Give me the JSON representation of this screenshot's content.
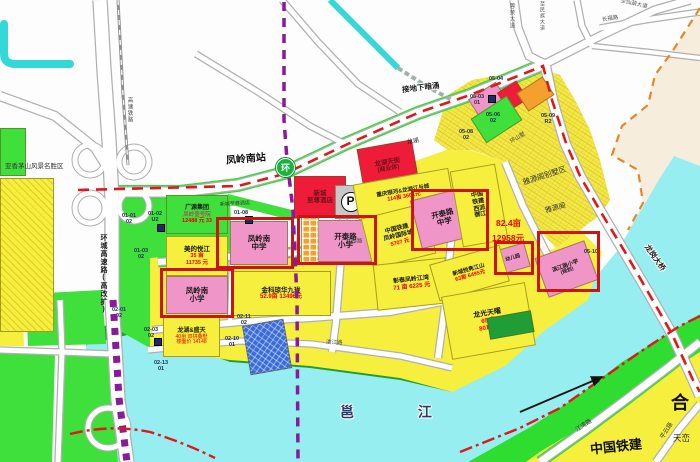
{
  "palette": {
    "yellow": "#f6ef3e",
    "green": "#3fe03c",
    "dark_green": "#1f9e38",
    "bright_green": "#2fdd30",
    "pink": "#f095c8",
    "red": "#ee1c38",
    "dark_red_text": "#70101c",
    "orange": "#f59f2f",
    "gray": "#c8c8c8",
    "blue": "#3a6cd8",
    "navy_icon": "#1a2a6a",
    "water": "#97eef0",
    "stream": "#35d8d8",
    "cream": "#f6eddc",
    "boundary_orange": "#e0882a",
    "red_line": "#e01818",
    "metro_purple": "#8a1a9a",
    "highlight_box": "#cc1414",
    "price_red": "#e60000",
    "text_dark": "#1a1a1a"
  },
  "station": {
    "t": "环",
    "name": "凤岭南站"
  },
  "labels": [
    {
      "id": "scenic-area-label",
      "t": "亚香茅山风景名胜区",
      "x": 5,
      "y": 164,
      "s": 6.5,
      "c": "#333333"
    },
    {
      "id": "ring-expressway-label",
      "t": "环城高速路(高改扩)",
      "x": 100,
      "y": 234,
      "s": 7,
      "b": 1,
      "v": 1,
      "c": "#1a1a1a"
    },
    {
      "id": "hsr-label",
      "t": "高速铁路",
      "x": 126,
      "y": 97,
      "s": 5.5,
      "v": 1,
      "c": "#444444"
    },
    {
      "id": "culvert-label",
      "t": "接地下暗涌",
      "x": 402,
      "y": 84,
      "s": 7.5,
      "b": 1,
      "r": -7,
      "c": "#1a1a1a",
      "halo": 1
    },
    {
      "id": "station-label",
      "t": "凤岭南站",
      "x": 226,
      "y": 155,
      "s": 10,
      "b": 1,
      "r": -5,
      "c": "#101010",
      "halo": 1
    },
    {
      "id": "rongmo-ave-label",
      "t": "蓉茉大道",
      "x": 508,
      "y": 3,
      "s": 5.5,
      "v": 1,
      "c": "#555555"
    },
    {
      "id": "minzu-ave-label",
      "t": "至民族大道",
      "x": 539,
      "y": 1,
      "s": 5,
      "v": 1,
      "c": "#555555"
    },
    {
      "id": "changfu-rd-label",
      "t": "长福路",
      "x": 602,
      "y": 17,
      "s": 5.5,
      "r": -9,
      "c": "#555555"
    },
    {
      "id": "xianhu-ave-label",
      "t": "至仙葫大道",
      "x": 620,
      "y": 2,
      "s": 5.5,
      "r": 13,
      "c": "#555555"
    },
    {
      "id": "longgang-bridge-label",
      "t": "龙岗大桥",
      "x": 640,
      "y": 254,
      "s": 7.5,
      "b": 1,
      "r": 55,
      "c": "#222222",
      "halo": 1
    },
    {
      "id": "jiangwan-rd-label",
      "t": "江湾路",
      "x": 575,
      "y": 423,
      "s": 6,
      "r": -33,
      "c": "#333333"
    },
    {
      "id": "pingyun-rd-label",
      "t": "平云路",
      "x": 658,
      "y": 428,
      "s": 6,
      "r": -58,
      "c": "#333333"
    },
    {
      "id": "binjiang-rd-label",
      "t": "滨江路",
      "x": 326,
      "y": 341,
      "s": 5.5,
      "r": 2,
      "c": "#444444"
    },
    {
      "id": "kaitai-rd-label",
      "t": "开泰路",
      "x": 346,
      "y": 240,
      "s": 5.5,
      "r": -4,
      "c": "#444444"
    },
    {
      "id": "yongjiang-river-label",
      "t": "邕 江",
      "x": 340,
      "y": 405,
      "s": 14,
      "b": 1,
      "sp": 30,
      "c": "#2b3a66",
      "halo": 1
    },
    {
      "id": "he-label",
      "t": "合",
      "x": 671,
      "y": 394,
      "s": 18,
      "b": 1,
      "c": "#111111"
    },
    {
      "id": "tianluan-label",
      "t": "天峦",
      "x": 673,
      "y": 434,
      "s": 8.5,
      "c": "#222222"
    },
    {
      "id": "tiejian-bottom-label",
      "t": "中国铁建",
      "x": 590,
      "y": 440,
      "s": 13,
      "b": 1,
      "r": -6,
      "c": "#111111"
    },
    {
      "id": "area-82-label",
      "t": "82.4亩",
      "x": 496,
      "y": 219,
      "s": 8.5,
      "b": 1,
      "c": "#e60000"
    },
    {
      "id": "price-12958-label",
      "t": "12958元",
      "x": 492,
      "y": 234,
      "s": 8.5,
      "b": 1,
      "c": "#e60000"
    },
    {
      "id": "yayuange-villa-label",
      "t": "雅源阁别墅区",
      "x": 522,
      "y": 172,
      "s": 7.5,
      "r": -18,
      "c": "#333333"
    },
    {
      "id": "yayuange-label",
      "t": "雅源阁",
      "x": 545,
      "y": 205,
      "s": 7,
      "r": -15,
      "c": "#333333"
    },
    {
      "id": "longhu-small-label",
      "t": "龙湖",
      "x": 407,
      "y": 139,
      "s": 6,
      "r": -10,
      "c": "#222222"
    },
    {
      "id": "hotel-small-label",
      "t": "新城至尊酒店",
      "x": 220,
      "y": 202,
      "s": 5,
      "r": -3,
      "c": "#333333"
    },
    {
      "id": "huanshanshu-label",
      "t": "环山墅",
      "x": 510,
      "y": 136,
      "s": 5.5,
      "r": -30,
      "c": "#444444"
    }
  ],
  "parcels": [
    {
      "id": "parcel-left-yellow",
      "x": 0,
      "y": 178,
      "w": 54,
      "h": 154,
      "fill": "yellow",
      "hatch": "diag"
    },
    {
      "id": "parcel-left-green",
      "x": 0,
      "y": 128,
      "w": 26,
      "h": 48,
      "fill": "green"
    },
    {
      "id": "parcel-guangyuan",
      "x": 166,
      "y": 195,
      "w": 62,
      "h": 39,
      "fill": "green",
      "lines": [
        {
          "t": "广源集团",
          "s": 6,
          "b": 1
        },
        {
          "t": "凤岭壹号院",
          "s": 5.5,
          "c": "#c02050"
        },
        {
          "t": "12488 元 33",
          "s": 5.5,
          "b": 1,
          "c": "#e60000"
        }
      ]
    },
    {
      "id": "parcel-meide-yuejiang",
      "x": 166,
      "y": 236,
      "w": 62,
      "h": 40,
      "fill": "yellow",
      "lines": [
        {
          "t": "美的悦江",
          "s": 6.5,
          "b": 1
        },
        {
          "t": "35 亩",
          "s": 5.5,
          "b": 1,
          "c": "#e60000"
        },
        {
          "t": "11735 元",
          "s": 5.5,
          "b": 1,
          "c": "#e60000"
        }
      ]
    },
    {
      "id": "parcel-fenglingnan-primary",
      "x": 166,
      "y": 276,
      "w": 62,
      "h": 38,
      "fill": "pink",
      "lines": [
        {
          "t": "凤岭南",
          "s": 7.5,
          "b": 1
        },
        {
          "t": "小学",
          "s": 7.5,
          "b": 1
        }
      ]
    },
    {
      "id": "parcel-fenglingnan-middle",
      "x": 230,
      "y": 221,
      "w": 58,
      "h": 44,
      "fill": "pink",
      "lines": [
        {
          "t": "凤岭南",
          "s": 7.5,
          "b": 1
        },
        {
          "t": "中学",
          "s": 7.5,
          "b": 1
        }
      ]
    },
    {
      "id": "parcel-jinke",
      "x": 231,
      "y": 271,
      "w": 100,
      "h": 45,
      "fill": "yellow",
      "lines": [
        {
          "t": "金科琼华九珑",
          "s": 6.5,
          "b": 1
        },
        {
          "t": "52.9亩 13496元",
          "s": 6,
          "b": 1,
          "c": "#e60000"
        }
      ]
    },
    {
      "id": "parcel-longhu-shengtian",
      "x": 163,
      "y": 317,
      "w": 57,
      "h": 40,
      "fill": "yellow",
      "lines": [
        {
          "t": "龙湖&盛天",
          "s": 6,
          "b": 1
        },
        {
          "t": "40亩 双拼叠墅",
          "s": 5,
          "c": "#e60000"
        },
        {
          "t": "楼面价 14148",
          "s": 5,
          "c": "#e60000"
        }
      ]
    },
    {
      "id": "parcel-blue-site",
      "x": 246,
      "y": 322,
      "w": 42,
      "h": 50,
      "rot": -10,
      "fill": "blue",
      "hatch": "grid"
    },
    {
      "id": "parcel-hotel",
      "x": 294,
      "y": 176,
      "w": 52,
      "h": 42,
      "fill": "red",
      "lines": [
        {
          "t": "新城",
          "s": 6.5,
          "b": 1,
          "c": "#70101c"
        },
        {
          "t": "至尊酒店",
          "s": 6.5,
          "b": 1,
          "c": "#70101c"
        }
      ]
    },
    {
      "id": "parcel-parking",
      "x": 335,
      "y": 185,
      "w": 31,
      "h": 34,
      "fill": "gray",
      "badge": "P"
    },
    {
      "id": "parcel-kaitai-primary",
      "x": 318,
      "y": 220,
      "w": 55,
      "h": 42,
      "fill": "pink",
      "lines": [
        {
          "t": "开泰路",
          "s": 7.5,
          "b": 1
        },
        {
          "t": "小学",
          "s": 7.5,
          "b": 1
        }
      ]
    },
    {
      "id": "parcel-orange-strip",
      "x": 301,
      "y": 217,
      "w": 18,
      "h": 47,
      "fill": "orange",
      "hatch": "cells"
    },
    {
      "id": "parcel-longhu-tianjie",
      "x": 360,
      "y": 144,
      "w": 56,
      "h": 44,
      "rot": -10,
      "fill": "red",
      "lines": [
        {
          "t": "龙湖天街",
          "s": 6.5,
          "b": 1,
          "c": "#70101c"
        },
        {
          "t": "(商业体)",
          "s": 6,
          "b": 1,
          "c": "#70101c"
        }
      ]
    },
    {
      "id": "parcel-chongqing-yinhe",
      "x": 355,
      "y": 176,
      "w": 97,
      "h": 36,
      "rot": -10,
      "fill": "yellow",
      "lines": [
        {
          "t": "重庆银河&龙湖江与城",
          "s": 5.5,
          "b": 1
        },
        {
          "t": "114亩 3601元",
          "s": 5.5,
          "b": 1,
          "c": "#e60000"
        }
      ]
    },
    {
      "id": "parcel-tiejian-guojicheng",
      "x": 366,
      "y": 210,
      "w": 65,
      "h": 52,
      "rot": -14,
      "fill": "yellow",
      "lines": [
        {
          "t": "中国铁建",
          "s": 6,
          "b": 1
        },
        {
          "t": "凤岭国际城",
          "s": 6,
          "b": 1
        },
        {
          "t": "5707 元",
          "s": 5.5,
          "b": 1,
          "c": "#e60000"
        }
      ]
    },
    {
      "id": "parcel-kaitai-middle",
      "x": 415,
      "y": 193,
      "w": 57,
      "h": 50,
      "rot": -14,
      "fill": "pink",
      "lines": [
        {
          "t": "开泰路",
          "s": 7.5,
          "b": 1
        },
        {
          "t": "中学",
          "s": 7.5,
          "b": 1
        }
      ]
    },
    {
      "id": "parcel-xipai-yujiang",
      "x": 456,
      "y": 167,
      "w": 46,
      "h": 77,
      "rot": -10,
      "fill": "yellow",
      "lines": [
        {
          "t": "中国",
          "s": 6,
          "b": 1
        },
        {
          "t": "铁建",
          "s": 6,
          "b": 1
        },
        {
          "t": "西派",
          "s": 6,
          "b": 1
        },
        {
          "t": "御江",
          "s": 6,
          "b": 1
        }
      ]
    },
    {
      "id": "parcel-kindergarten",
      "x": 498,
      "y": 246,
      "w": 30,
      "h": 25,
      "rot": -16,
      "fill": "pink",
      "lines": [
        {
          "t": "幼儿园",
          "s": 5,
          "b": 1
        }
      ]
    },
    {
      "id": "parcel-binjiang-primary",
      "x": 540,
      "y": 248,
      "w": 53,
      "h": 42,
      "rot": -20,
      "fill": "pink",
      "lines": [
        {
          "t": "滨江路小学",
          "s": 5.5,
          "b": 1
        },
        {
          "t": "(规划)",
          "s": 5,
          "b": 1
        }
      ]
    },
    {
      "id": "parcel-zhangtai-jiangwan",
      "x": 375,
      "y": 261,
      "w": 73,
      "h": 46,
      "rot": -6,
      "fill": "yellow",
      "lines": [
        {
          "t": "彰泰凤岭江湾",
          "s": 6,
          "b": 1
        },
        {
          "t": "71 亩 6225 元",
          "s": 6,
          "b": 1,
          "c": "#e60000"
        }
      ]
    },
    {
      "id": "parcel-xincheng-yujun",
      "x": 433,
      "y": 254,
      "w": 73,
      "h": 38,
      "rot": -16,
      "fill": "yellow",
      "lines": [
        {
          "t": "新城悦隽江山",
          "s": 5.5,
          "b": 1
        },
        {
          "t": "63亩 6495元",
          "s": 5.5,
          "b": 1,
          "c": "#e60000"
        }
      ]
    },
    {
      "id": "parcel-longguang-tianyao",
      "x": 446,
      "y": 289,
      "w": 85,
      "h": 64,
      "rot": -10,
      "fill": "yellow",
      "lines": [
        {
          "t": "龙光天曜",
          "s": 7,
          "b": 1
        },
        {
          "t": "65 亩",
          "s": 6,
          "b": 1,
          "c": "#e60000"
        },
        {
          "t": "8018 元",
          "s": 6,
          "b": 1,
          "c": "#e60000"
        }
      ]
    },
    {
      "id": "parcel-darkgreen-inset",
      "x": 488,
      "y": 314,
      "w": 45,
      "h": 22,
      "rot": -10,
      "fill": "dark_green"
    },
    {
      "id": "parcel-ne-pink",
      "x": 471,
      "y": 89,
      "w": 33,
      "h": 21,
      "rot": -33,
      "fill": "pink"
    },
    {
      "id": "parcel-ne-red",
      "x": 501,
      "y": 85,
      "w": 23,
      "h": 22,
      "rot": -33,
      "fill": "red"
    },
    {
      "id": "parcel-ne-orange",
      "x": 520,
      "y": 83,
      "w": 31,
      "h": 22,
      "rot": -33,
      "fill": "orange"
    },
    {
      "id": "parcel-ne-green",
      "x": 475,
      "y": 105,
      "w": 43,
      "h": 29,
      "rot": -33,
      "fill": "green"
    }
  ],
  "boxes": [
    {
      "id": "highlight-fenglingnan-primary",
      "x": 160,
      "y": 268,
      "w": 74,
      "h": 50
    },
    {
      "id": "highlight-fenglingnan-middle",
      "x": 216,
      "y": 217,
      "w": 78,
      "h": 52
    },
    {
      "id": "highlight-kaitai-primary",
      "x": 297,
      "y": 215,
      "w": 80,
      "h": 50
    },
    {
      "id": "highlight-kaitai-middle",
      "x": 411,
      "y": 189,
      "w": 78,
      "h": 62
    },
    {
      "id": "highlight-kindergarten",
      "x": 494,
      "y": 241,
      "w": 40,
      "h": 34
    },
    {
      "id": "highlight-binjiang-primary",
      "x": 537,
      "y": 231,
      "w": 63,
      "h": 61
    }
  ],
  "codes": [
    {
      "l1": "01-01",
      "l2": "02",
      "x": 122,
      "y": 214
    },
    {
      "l1": "01-02",
      "l2": "U2",
      "x": 148,
      "y": 212
    },
    {
      "l1": "01-03",
      "l2": "02",
      "x": 134,
      "y": 249
    },
    {
      "l1": "01-08",
      "l2": "",
      "x": 234,
      "y": 211
    },
    {
      "l1": "02-01",
      "l2": "02",
      "x": 112,
      "y": 308
    },
    {
      "l1": "02-03",
      "l2": "02",
      "x": 144,
      "y": 328
    },
    {
      "l1": "02-13",
      "l2": "01",
      "x": 154,
      "y": 361
    },
    {
      "l1": "02-11",
      "l2": "02",
      "x": 237,
      "y": 315
    },
    {
      "l1": "02-10",
      "l2": "01",
      "x": 225,
      "y": 337
    },
    {
      "l1": "05-03",
      "l2": "01",
      "x": 470,
      "y": 95
    },
    {
      "l1": "05-04",
      "l2": "",
      "x": 489,
      "y": 77
    },
    {
      "l1": "05-06",
      "l2": "02",
      "x": 486,
      "y": 113
    },
    {
      "l1": "05-08",
      "l2": "02",
      "x": 459,
      "y": 130
    },
    {
      "l1": "05-09",
      "l2": "R2",
      "x": 541,
      "y": 114
    },
    {
      "l1": "05-10",
      "l2": "",
      "x": 584,
      "y": 250
    }
  ],
  "icon_squares": [
    {
      "x": 157,
      "y": 224
    },
    {
      "x": 154,
      "y": 338
    },
    {
      "x": 245,
      "y": 216
    },
    {
      "x": 488,
      "y": 95
    }
  ]
}
